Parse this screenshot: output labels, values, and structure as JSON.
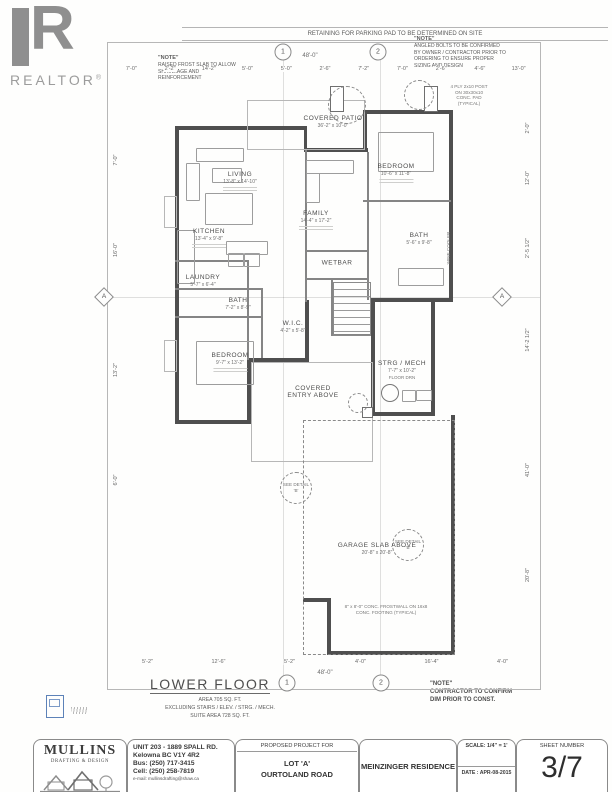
{
  "branding": {
    "realtor": "REALTOR",
    "reg": "®"
  },
  "top_banner": "RETAINING FOR PARKING PAD TO BE DETERMINED ON SITE",
  "notes": {
    "left_title": "\"NOTE\"",
    "left_body": "RAISED FROST SLAB TO ALLOW SHRINKAGE AND REINFORCEMENT",
    "right_title": "\"NOTE\"",
    "right_body": "ANGLED BOLTS TO BE CONFIRMED BY OWNER / CONTRACTOR PRIOR TO ORDERING TO ENSURE PROPER SIZING AND DESIGN",
    "bottom_title": "\"NOTE\"",
    "bottom_line1": "CONTRACTOR TO CONFIRM",
    "bottom_line2": "DIM PRIOR TO CONST."
  },
  "rooms": [
    {
      "id": "living",
      "name": "LIVING",
      "dims": "13'-8\" x 14'-10\""
    },
    {
      "id": "kitchen",
      "name": "KITCHEN",
      "dims": "13'-4\" x 9'-8\""
    },
    {
      "id": "family",
      "name": "FAMILY",
      "dims": "14'-4\" x 17'-2\""
    },
    {
      "id": "bedroom-upper",
      "name": "BEDROOM",
      "dims": "10'-6\" x 11'-8\""
    },
    {
      "id": "bath-right",
      "name": "BATH",
      "dims": "5'-6\" x 9'-8\""
    },
    {
      "id": "wetbar",
      "name": "WETBAR",
      "dims": ""
    },
    {
      "id": "laundry",
      "name": "LAUNDRY",
      "dims": "5'-7\" x 6'-4\""
    },
    {
      "id": "bath-left",
      "name": "BATH",
      "dims": "7'-2\" x 8'-9\""
    },
    {
      "id": "wic",
      "name": "W.I.C.",
      "dims": "4'-2\" x 5'-8\""
    },
    {
      "id": "bedroom-lower",
      "name": "BEDROOM",
      "dims": "9'-7\" x 13'-2\""
    },
    {
      "id": "strg-mech",
      "name": "STRG / MECH",
      "dims": "7'-7\" x 10'-2\"",
      "extra": "FLOOR DRN"
    },
    {
      "id": "covered-entry",
      "name": "COVERED ENTRY ABOVE",
      "dims": ""
    },
    {
      "id": "covered-patio",
      "name": "COVERED PATIO",
      "dims": "36'-2\" x 10'-0\""
    },
    {
      "id": "garage-slab",
      "name": "GARAGE SLAB ABOVE",
      "dims": "20'-8\" x 20'-8\""
    }
  ],
  "annotations": [
    {
      "id": "post-note",
      "text": "4 PLY 2x10 POST ON 30x30x10 CONC. PAD (TYPICAL)"
    },
    {
      "id": "frostwall-note",
      "text": "8\" x 8'-0\" CONC. FROSTWALL ON 16x8 CONC. FOOTING (TYPICAL)"
    },
    {
      "id": "see-detail-1",
      "text": "SEE DETAIL 'B'"
    },
    {
      "id": "see-detail-2",
      "text": "SEE DETAIL 'B'"
    },
    {
      "id": "wine-cooler",
      "text": "WINE COOLER"
    }
  ],
  "grid_bubbles": {
    "b1": "1",
    "b2": "2",
    "side": "A"
  },
  "dimensions": {
    "overall_width": "48'-0\"",
    "top_segments": [
      "7'-0\"",
      "2'-2\"",
      "14'-2\"",
      "5'-0\"",
      "5'-0\"",
      "2'-6\"",
      "7'-2\"",
      "7'-0\"",
      "2'-6\"",
      "4'-6\"",
      "13'-0\""
    ],
    "bottom_segments": [
      "5'-2\"",
      "12'-6\"",
      "5'-2\"",
      "4'-0\"",
      "16'-4\"",
      "4'-0\""
    ],
    "bottom_overall": "48'-0\"",
    "left_segments": [
      "7'-0\"",
      "16'-0\"",
      "13'-2\"",
      "6'-0\""
    ],
    "right_segments": [
      "2'-0\"",
      "12'-0\"",
      "2'-5 1/2\"",
      "14'-2 1/2\"",
      "41'-0\"",
      "20'-8\""
    ]
  },
  "lower_floor": {
    "title": "LOWER FLOOR",
    "area_line": "AREA      705 SQ. FT.",
    "excluding_line": "EXCLUDING STAIRS / ELEV. / STRG. / MECH.",
    "suite_line": "SUITE AREA      728 SQ. FT."
  },
  "title_block": {
    "company": "MULLINS",
    "company_sub": "DRAFTING & DESIGN",
    "address1": "UNIT 203 - 1889 SPALL RD.",
    "address2": "Kelowna BC V1Y 4R2",
    "phone1": "Bus: (250) 717-3415",
    "phone2": "Cell: (250) 258-7819",
    "email": "e-mail: mullinsdrafting@shaw.ca",
    "project_header": "PROPOSED PROJECT FOR",
    "project_line1": "LOT 'A'",
    "project_line2": "OURTOLAND ROAD",
    "residence": "MEINZINGER RESIDENCE",
    "scale": "SCALE: 1/4\" = 1'",
    "date": "DATE : APR-08-2015",
    "sheet_header": "SHEET NUMBER",
    "sheet_number": "3/7"
  }
}
